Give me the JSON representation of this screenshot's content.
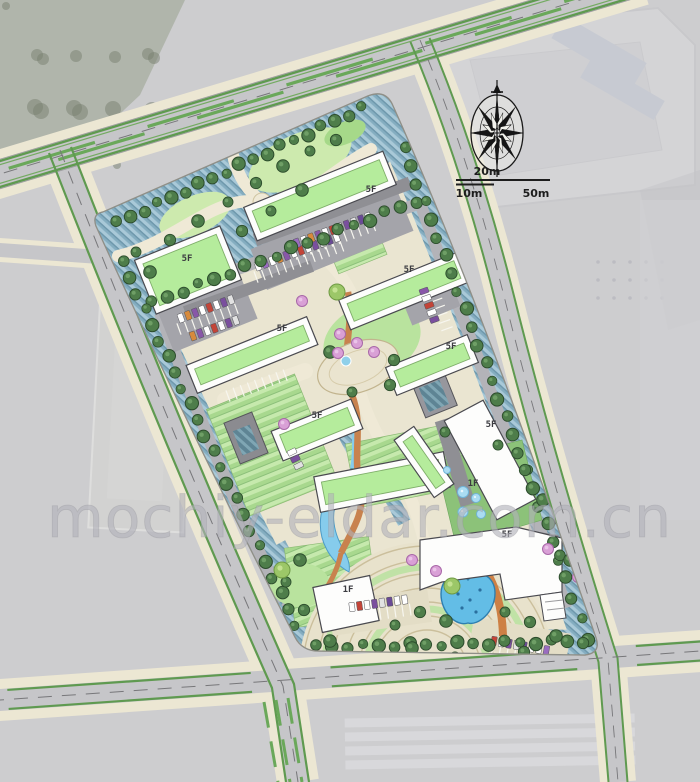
{
  "page": {
    "type": "architectural-site-master-plan",
    "description": "Colored landscape master plan of an office park rendered over a faded grayscale aerial photo"
  },
  "watermark": {
    "text": "mochiy-eldar.com.cn"
  },
  "scale_bar": {
    "upper_label": "20m",
    "lower_left_label": "10m",
    "lower_right_label": "50m"
  },
  "icons": {
    "compass": "compass-rose-icon"
  },
  "building_labels": [
    {
      "label": "5F"
    },
    {
      "label": "5F"
    },
    {
      "label": "5F"
    },
    {
      "label": "5F"
    },
    {
      "label": "5F"
    },
    {
      "label": "5F"
    },
    {
      "label": "5F"
    },
    {
      "label": "5F"
    },
    {
      "label": "1F"
    },
    {
      "label": "1F"
    }
  ],
  "colors": {
    "aerial_gray": "#cdcdcf",
    "road_gray": "#c6c6c9",
    "sidewalk_cream": "#ece7d3",
    "site_base": "#eae5d1",
    "roof_green": "#b5ec9c",
    "lawn_green": "#b9e39e",
    "tree_green": "#4e7d4a",
    "hatch_blue": "#84adc0",
    "water_blue": "#63bde6",
    "path_orange": "#c8824e",
    "flower_pink": "#d9a0d6",
    "median_green": "#5f9a50",
    "compass_ink": "#151515"
  }
}
